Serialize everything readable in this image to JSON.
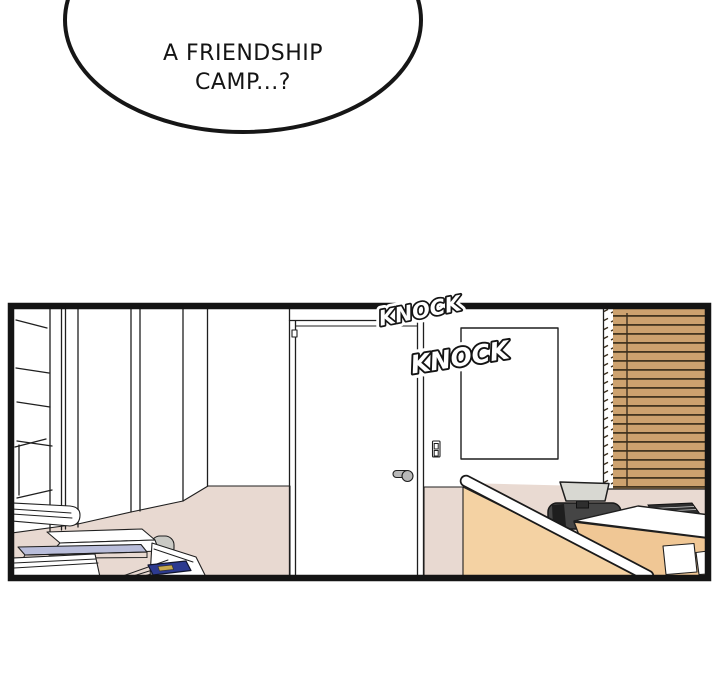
{
  "bubble": {
    "line1": "A FRIENDSHIP",
    "line2": "CAMP...?"
  },
  "sfx": {
    "knock1": "KNOCK",
    "knock2": "KNOCK"
  },
  "colors": {
    "white": "#ffffff",
    "wall_beige": "#e9dad2",
    "floor": "#e8d9d1",
    "blinds_slat": "#cda26f",
    "blinds_gap": "#453621",
    "blinds_cord": "#3c2f1e",
    "partition": "#f4d2a3",
    "desk_front": "#f0c795",
    "monitor": "#d8d8d2",
    "equipment_dark": "#2e2e2e",
    "chair": "#454545",
    "chair_shadow": "#1e1e1e",
    "printer_cap": "#c9c9c4",
    "tray_top": "#b9bdda",
    "tray_front": "#8f96c0",
    "binder": "#2c3a90",
    "binder_label": "#c8a94e",
    "handle_gray": "#b9b9b9"
  }
}
